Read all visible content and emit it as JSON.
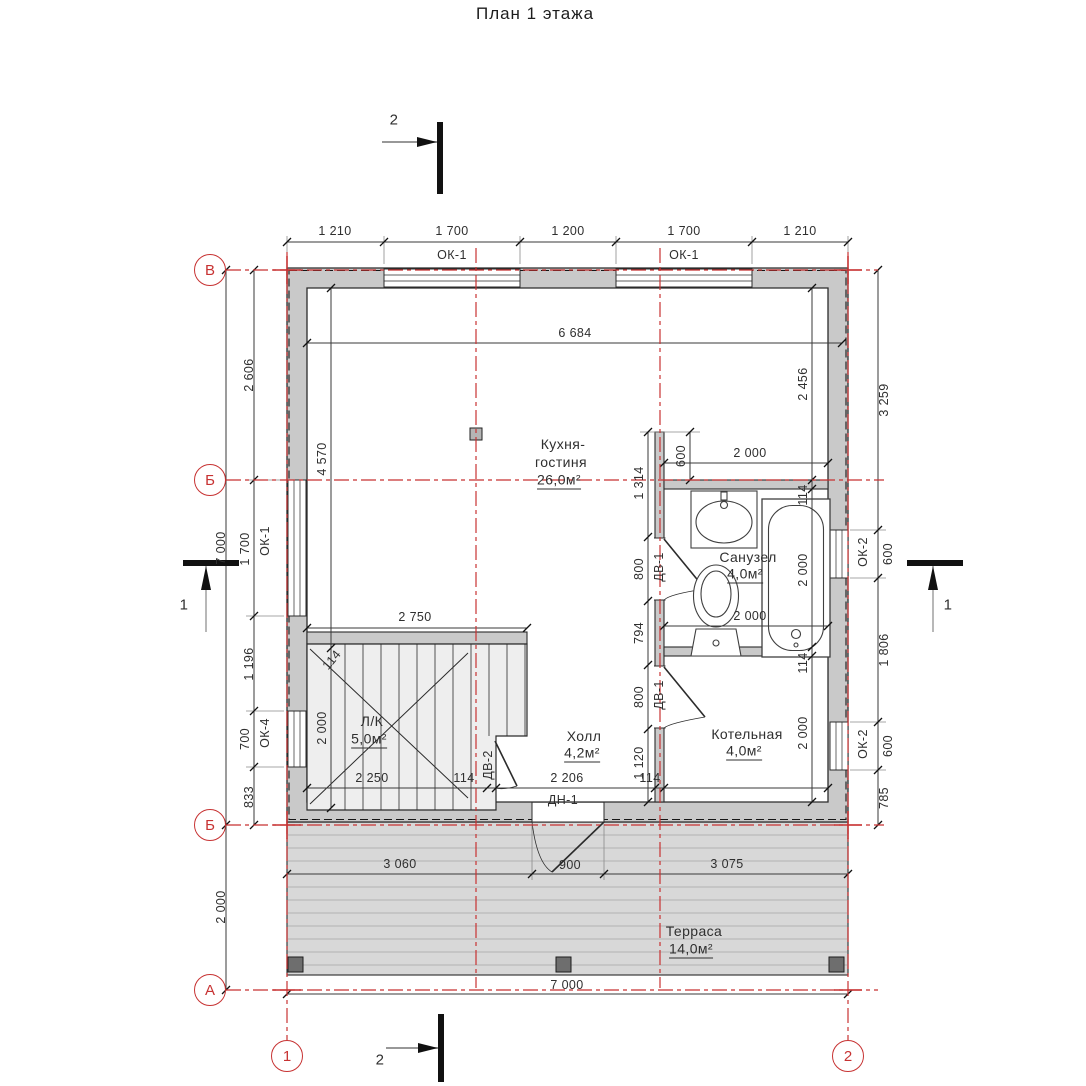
{
  "title": "План 1 этажа",
  "colors": {
    "axis_red": "#c73232",
    "dim_line": "#3a3a3a",
    "wall_fill": "#c9c9c9",
    "terrace_fill": "#d8d8d8"
  },
  "axis_markers": [
    {
      "n": "axis-row-v",
      "label": "В",
      "x": 210,
      "y": 270
    },
    {
      "n": "axis-row-b-upper",
      "label": "Б",
      "x": 210,
      "y": 480
    },
    {
      "n": "axis-row-b-lower",
      "label": "Б",
      "x": 210,
      "y": 825
    },
    {
      "n": "axis-row-a",
      "label": "А",
      "x": 210,
      "y": 990
    },
    {
      "n": "axis-col-1",
      "label": "1",
      "x": 287,
      "y": 1056
    },
    {
      "n": "axis-col-2",
      "label": "2",
      "x": 848,
      "y": 1056
    }
  ],
  "labels": [
    {
      "n": "dim-top-1",
      "t": "1 210",
      "x": 335,
      "y": 231
    },
    {
      "n": "dim-top-2",
      "t": "1 700",
      "x": 452,
      "y": 231
    },
    {
      "n": "dim-top-3",
      "t": "1 200",
      "x": 568,
      "y": 231
    },
    {
      "n": "dim-top-4",
      "t": "1 700",
      "x": 684,
      "y": 231
    },
    {
      "n": "dim-top-5",
      "t": "1 210",
      "x": 800,
      "y": 231
    },
    {
      "n": "window-label-ok1-top-left",
      "t": "ОК-1",
      "x": 452,
      "y": 255
    },
    {
      "n": "window-label-ok1-top-right",
      "t": "ОК-1",
      "x": 684,
      "y": 255
    },
    {
      "n": "dim-left-total",
      "t": "7 000",
      "x": 221,
      "y": 548,
      "r": -90
    },
    {
      "n": "dim-left-terrace",
      "t": "2 000",
      "x": 221,
      "y": 907,
      "r": -90
    },
    {
      "n": "dim-left-1",
      "t": "2 606",
      "x": 249,
      "y": 375,
      "r": -90
    },
    {
      "n": "dim-left-2",
      "t": "1 700",
      "x": 245,
      "y": 549,
      "r": -90
    },
    {
      "n": "window-label-ok1-left",
      "t": "ОК-1",
      "x": 265,
      "y": 541,
      "r": -90
    },
    {
      "n": "dim-left-3",
      "t": "1 196",
      "x": 249,
      "y": 664,
      "r": -90
    },
    {
      "n": "dim-left-4",
      "t": "700",
      "x": 245,
      "y": 739,
      "r": -90
    },
    {
      "n": "window-label-ok4-left",
      "t": "ОК-4",
      "x": 265,
      "y": 733,
      "r": -90
    },
    {
      "n": "dim-left-5",
      "t": "833",
      "x": 249,
      "y": 797,
      "r": -90
    },
    {
      "n": "dim-right-1",
      "t": "3 259",
      "x": 884,
      "y": 400,
      "r": -90
    },
    {
      "n": "dim-right-2",
      "t": "600",
      "x": 888,
      "y": 554,
      "r": -90
    },
    {
      "n": "window-label-ok2-upper",
      "t": "ОК-2",
      "x": 863,
      "y": 552,
      "r": -90
    },
    {
      "n": "dim-right-3",
      "t": "1 806",
      "x": 884,
      "y": 650,
      "r": -90
    },
    {
      "n": "dim-right-4",
      "t": "600",
      "x": 888,
      "y": 746,
      "r": -90
    },
    {
      "n": "window-label-ok2-lower",
      "t": "ОК-2",
      "x": 863,
      "y": 744,
      "r": -90
    },
    {
      "n": "dim-right-5",
      "t": "785",
      "x": 884,
      "y": 798,
      "r": -90
    },
    {
      "n": "dim-bottom-total",
      "t": "7 000",
      "x": 567,
      "y": 985
    },
    {
      "n": "dim-terrace-1",
      "t": "3 060",
      "x": 400,
      "y": 864
    },
    {
      "n": "dim-terrace-door",
      "t": "900",
      "x": 570,
      "y": 865
    },
    {
      "n": "dim-terrace-2",
      "t": "3 075",
      "x": 727,
      "y": 864
    },
    {
      "n": "dim-int-width",
      "t": "6 684",
      "x": 575,
      "y": 333
    },
    {
      "n": "dim-int-height",
      "t": "4 570",
      "x": 322,
      "y": 459,
      "r": -90
    },
    {
      "n": "dim-stair-width",
      "t": "2 000",
      "x": 322,
      "y": 728,
      "r": -90
    },
    {
      "n": "dim-stair-wall",
      "t": "114",
      "x": 332,
      "y": 660,
      "r": -50
    },
    {
      "n": "dim-int-right",
      "t": "2 456",
      "x": 803,
      "y": 384,
      "r": -90
    },
    {
      "n": "dim-wall-top",
      "t": "1 314",
      "x": 639,
      "y": 483,
      "r": -90
    },
    {
      "n": "dim-bath-offset",
      "t": "600",
      "x": 681,
      "y": 456,
      "r": -90
    },
    {
      "n": "dim-bath-top",
      "t": "2 000",
      "x": 750,
      "y": 453
    },
    {
      "n": "dim-bath-wall",
      "t": "114",
      "x": 803,
      "y": 495,
      "r": -90
    },
    {
      "n": "dim-bath-height",
      "t": "2 000",
      "x": 803,
      "y": 570,
      "r": -90
    },
    {
      "n": "dim-bath-bottom",
      "t": "2 000",
      "x": 750,
      "y": 616
    },
    {
      "n": "dim-boiler-wall",
      "t": "114",
      "x": 803,
      "y": 663,
      "r": -90
    },
    {
      "n": "dim-boiler-height",
      "t": "2 000",
      "x": 803,
      "y": 733,
      "r": -90
    },
    {
      "n": "dim-door1",
      "t": "800",
      "x": 639,
      "y": 569,
      "r": -90
    },
    {
      "n": "door-label-dv1-bath",
      "t": "ДВ-1",
      "x": 659,
      "y": 567,
      "r": -90
    },
    {
      "n": "dim-wall-mid",
      "t": "794",
      "x": 639,
      "y": 633,
      "r": -90
    },
    {
      "n": "dim-door2",
      "t": "800",
      "x": 639,
      "y": 697,
      "r": -90
    },
    {
      "n": "door-label-dv1-boiler",
      "t": "ДВ-1",
      "x": 659,
      "y": 695,
      "r": -90
    },
    {
      "n": "dim-wall-bottom",
      "t": "1 120",
      "x": 639,
      "y": 763,
      "r": -90
    },
    {
      "n": "dim-stair-length",
      "t": "2 750",
      "x": 415,
      "y": 617
    },
    {
      "n": "dim-stair-bottom",
      "t": "2 250",
      "x": 372,
      "y": 778
    },
    {
      "n": "dim-stair-stub",
      "t": "114",
      "x": 464,
      "y": 778
    },
    {
      "n": "door-label-dv2-stair",
      "t": "ДВ-2",
      "x": 488,
      "y": 765,
      "r": -90
    },
    {
      "n": "dim-hall",
      "t": "2 206",
      "x": 567,
      "y": 778
    },
    {
      "n": "dim-hall-wall",
      "t": "114",
      "x": 650,
      "y": 778
    },
    {
      "n": "door-label-dn1-entry",
      "t": "ДН-1",
      "x": 563,
      "y": 800
    },
    {
      "n": "room-kitchen-line1",
      "t": "Кухня-",
      "x": 563,
      "y": 444,
      "s": 14
    },
    {
      "n": "room-kitchen-line2",
      "t": "гостиня",
      "x": 561,
      "y": 462,
      "s": 14
    },
    {
      "n": "room-kitchen-area",
      "t": "26,0м²",
      "x": 559,
      "y": 481,
      "s": 14,
      "u": 1
    },
    {
      "n": "room-bathroom-name",
      "t": "Санузел",
      "x": 748,
      "y": 557,
      "s": 14
    },
    {
      "n": "room-bathroom-area",
      "t": "4,0м²",
      "x": 745,
      "y": 575,
      "s": 14,
      "u": 1
    },
    {
      "n": "room-boiler-name",
      "t": "Котельная",
      "x": 747,
      "y": 734,
      "s": 14
    },
    {
      "n": "room-boiler-area",
      "t": "4,0м²",
      "x": 744,
      "y": 752,
      "s": 14,
      "u": 1
    },
    {
      "n": "room-hall-name",
      "t": "Холл",
      "x": 584,
      "y": 736,
      "s": 14
    },
    {
      "n": "room-hall-area",
      "t": "4,2м²",
      "x": 582,
      "y": 754,
      "s": 14,
      "u": 1
    },
    {
      "n": "room-stair-name",
      "t": "Л/К",
      "x": 372,
      "y": 721,
      "s": 14
    },
    {
      "n": "room-stair-area",
      "t": "5,0м²",
      "x": 369,
      "y": 740,
      "s": 14,
      "u": 1
    },
    {
      "n": "room-terrace-name",
      "t": "Терраса",
      "x": 694,
      "y": 931,
      "s": 14
    },
    {
      "n": "room-terrace-area",
      "t": "14,0м²",
      "x": 691,
      "y": 950,
      "s": 14,
      "u": 1
    },
    {
      "n": "section-mark-2-top-label",
      "t": "2",
      "x": 394,
      "y": 120,
      "s": 15
    },
    {
      "n": "section-mark-2-bottom-label",
      "t": "2",
      "x": 380,
      "y": 1060,
      "s": 15
    },
    {
      "n": "section-mark-1-left-label",
      "t": "1",
      "x": 184,
      "y": 605,
      "s": 15
    },
    {
      "n": "section-mark-1-right-label",
      "t": "1",
      "x": 948,
      "y": 605,
      "s": 15
    }
  ]
}
